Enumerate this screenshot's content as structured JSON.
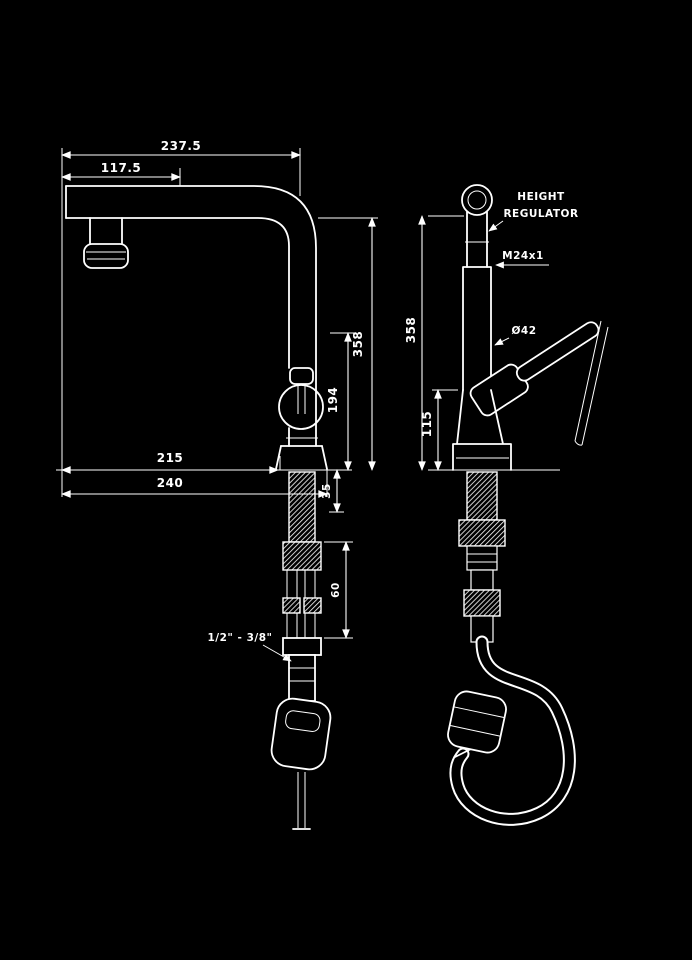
{
  "drawing": {
    "background_color": "#000000",
    "line_color": "#ffffff",
    "front_view": {
      "dim_spout_reach": "237.5",
      "dim_tip_offset": "117.5",
      "dim_height_above_deck": "358",
      "dim_clearance": "194",
      "dim_reach_to_base": "215",
      "dim_overall_depth": "240",
      "dim_deck_thickness": "35",
      "dim_shank_length": "60",
      "label_hose_threads": "1/2\" - 3/8\""
    },
    "side_view": {
      "label_regulator_line1": "HEIGHT",
      "label_regulator_line2": "REGULATOR",
      "label_aerator_thread": "M24x1",
      "label_body_diameter": "Ø42",
      "dim_height_above_deck": "358",
      "dim_body_height": "115"
    }
  }
}
